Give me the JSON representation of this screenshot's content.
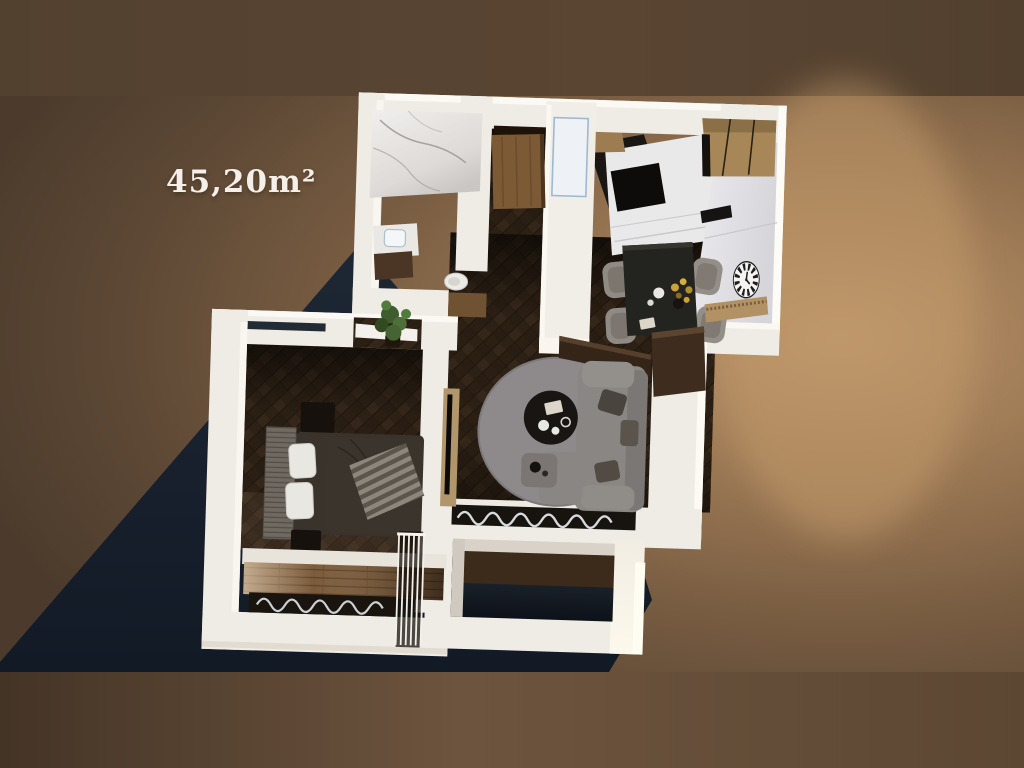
{
  "scene": {
    "area_label": "45,20m²",
    "render_type": "top-down 3D apartment floor plan render"
  },
  "palette": {
    "backdrop_wall_band": "#57432f",
    "backdrop_glow": "#b9936a",
    "backdrop_edge": "#4e3c2d",
    "backdrop_bottom_band": "#66503b",
    "cast_shadow": "#161e2c",
    "walls": "#efebe5",
    "wood_floor": "#2b1f14",
    "kitchen_wood": "#a78757",
    "marble": "#eceae8",
    "rug": "#8e898b",
    "sofa": "#8a8683",
    "balcony_planks": "#7b5b3b"
  },
  "rooms": [
    {
      "id": "bathroom",
      "label": "bathroom",
      "features": [
        "marble-wall",
        "vanity-sink",
        "toilet"
      ]
    },
    {
      "id": "hallway",
      "label": "hallway",
      "features": [
        "entry-door",
        "plant"
      ]
    },
    {
      "id": "kitchen",
      "label": "kitchen",
      "features": [
        "tall-wood-cabinets",
        "island-counter",
        "cooktop",
        "glass-cabinet"
      ]
    },
    {
      "id": "dining",
      "label": "dining-area",
      "features": [
        "table",
        "four-chairs",
        "flower-vase",
        "wall-clock",
        "sideboard"
      ]
    },
    {
      "id": "living",
      "label": "living-room",
      "features": [
        "corner-sofa",
        "round-rug",
        "coffee-table",
        "tv-console",
        "media-shelf",
        "window-radiator"
      ]
    },
    {
      "id": "bedroom",
      "label": "bedroom",
      "features": [
        "double-bed",
        "ribbed-headboard",
        "two-pillows",
        "striped-throw",
        "two-nightstands"
      ]
    },
    {
      "id": "balconies",
      "label": "balconies",
      "features": [
        "plank-floor",
        "window-radiator",
        "white-railing",
        "loggia"
      ]
    }
  ]
}
